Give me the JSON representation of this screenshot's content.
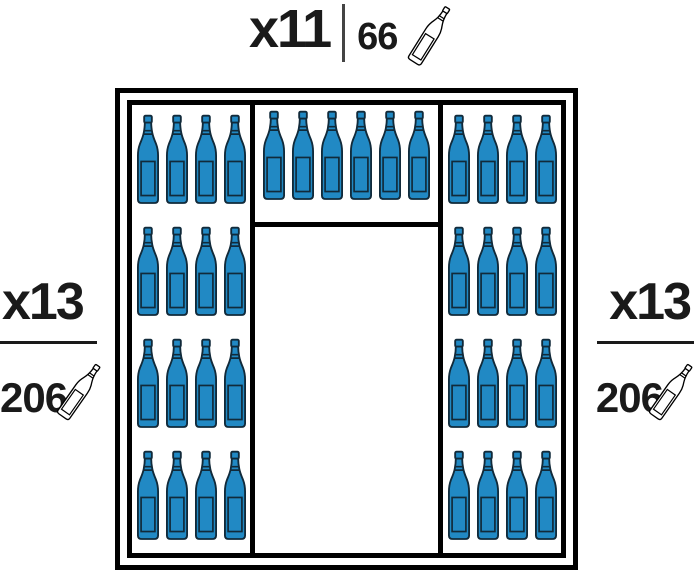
{
  "labels": {
    "top": {
      "multiplier": "x11",
      "count": "66",
      "icon": "empty-bottle-icon"
    },
    "left": {
      "multiplier": "x13",
      "count": "206",
      "icon": "empty-bottle-icon"
    },
    "right": {
      "multiplier": "x13",
      "count": "206",
      "icon": "empty-bottle-icon"
    }
  },
  "cabinet": {
    "sections": {
      "left": {
        "rows": 4,
        "bottles_per_row": 4,
        "total_bottles": 16
      },
      "middle": {
        "rows": 1,
        "bottles_per_row": 6,
        "total_bottles": 6,
        "empty_compartment_below": true
      },
      "right": {
        "rows": 4,
        "bottles_per_row": 4,
        "total_bottles": 16
      }
    },
    "bottle_icon": "wine-bottle-icon"
  },
  "colors": {
    "bottle_fill": "#2189C4",
    "bottle_outline": "#112A3A",
    "frame": "#000000",
    "text": "#1A1A1A",
    "icon_fill": "#FFFFFF",
    "icon_outline": "#000000",
    "divider": "#444444"
  }
}
